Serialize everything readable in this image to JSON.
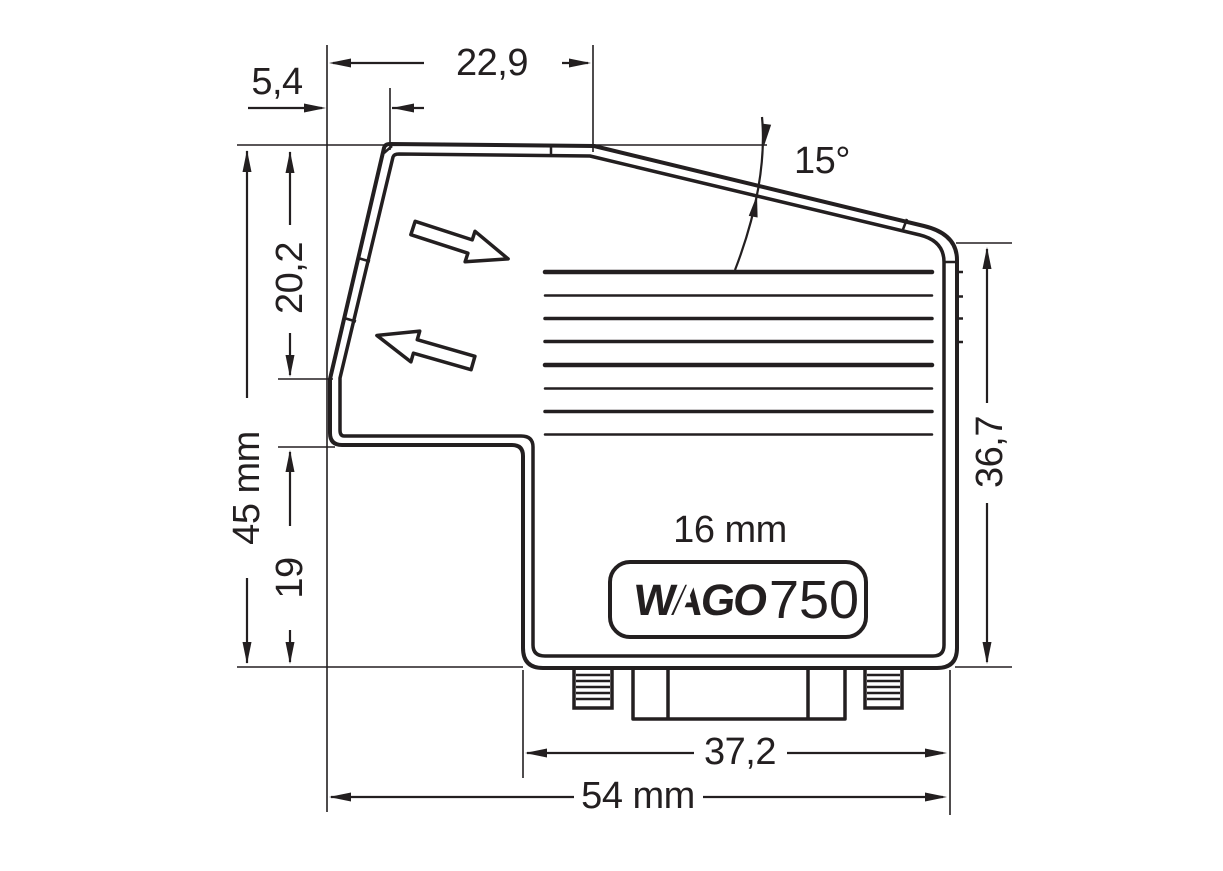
{
  "title": "WAGO 750 connector housing side-view dimensional drawing",
  "labels": {
    "dim_top_width": "22,9",
    "dim_top_offset": "5,4",
    "angle": "15°",
    "dim_upper_height": "20,2",
    "dim_total_height": "45 mm",
    "dim_lower_height": "19",
    "dim_right_height": "36,7",
    "marking_width": "16 mm",
    "dim_connector_width": "37,2",
    "dim_total_width": "54 mm"
  },
  "logo": {
    "brand": "WAGO",
    "series": "750"
  },
  "colors": {
    "line": "#231f20",
    "background": "#ffffff"
  }
}
